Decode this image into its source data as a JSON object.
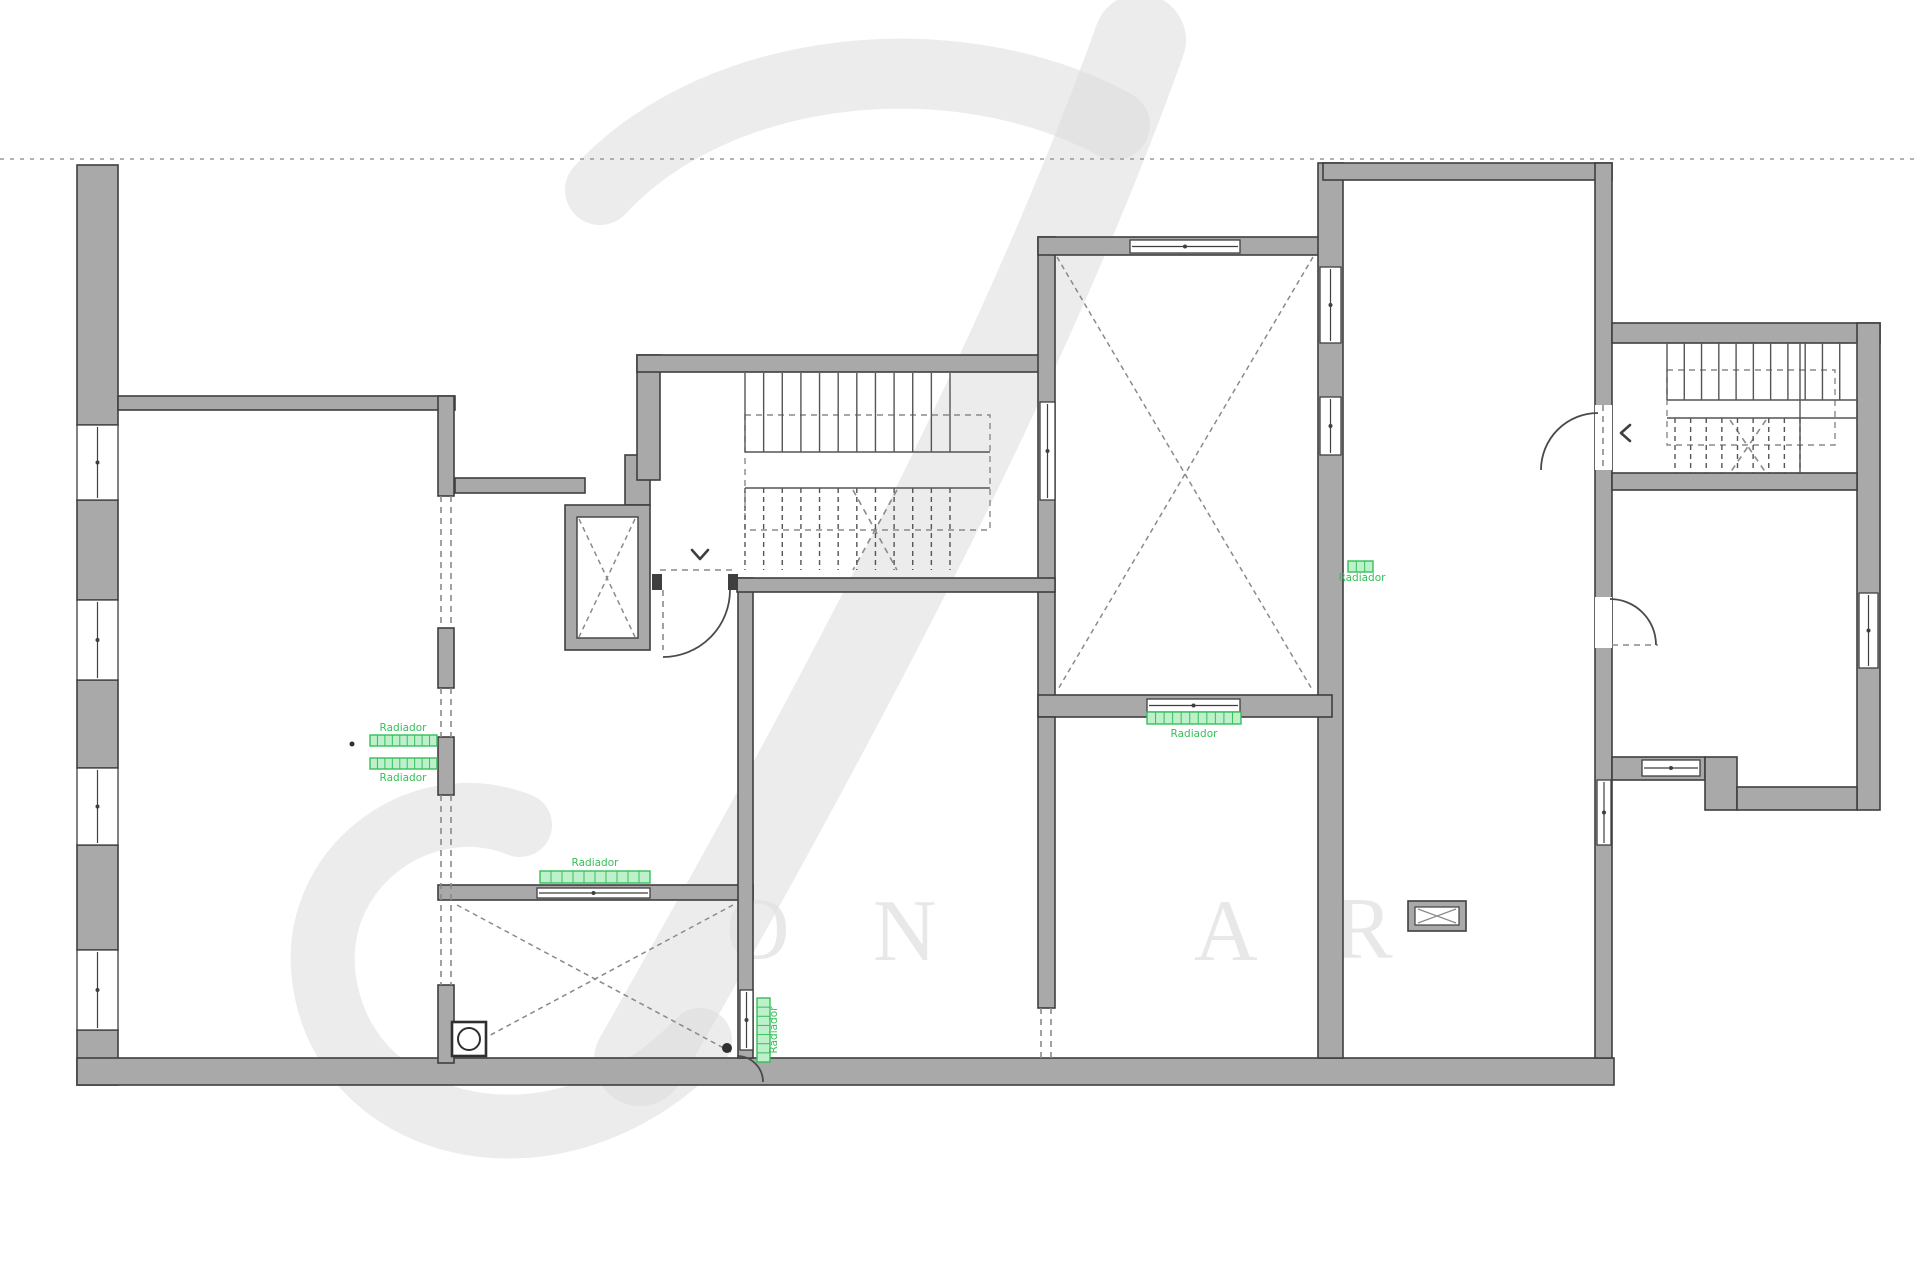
{
  "meta": {
    "title": "Apartment floor plan drawing"
  },
  "colors": {
    "background": "#ffffff",
    "wall_fill": "#a9a9a9",
    "wall_stroke": "#3f3f3f",
    "line_dark": "#3f3f3f",
    "dash_gray": "#8a8a8a",
    "green": "#35c05a",
    "watermark": "#dcdcdc",
    "watermark_letter": "#e3e3e3",
    "boundary_dotted": "#9a9a9a"
  },
  "watermark": {
    "strokes": [
      {
        "d": "M 1140,40 C 1040,320 880,640 640,1060",
        "width": 92
      },
      {
        "d": "M 600,190 C 720,60 960,40 1115,125",
        "width": 70
      },
      {
        "d": "M 700,1040 C 560,1185 350,1135 325,985 C 305,870 420,785 520,825",
        "width": 64
      }
    ],
    "letters": [
      {
        "ch": "O",
        "x": 726,
        "y": 958
      },
      {
        "ch": "N",
        "x": 873,
        "y": 960
      },
      {
        "ch": "A",
        "x": 1194,
        "y": 960
      },
      {
        "ch": "R",
        "x": 1334,
        "y": 958
      }
    ]
  },
  "plan": {
    "boundary_line": {
      "y": 159,
      "x1": 0,
      "x2": 1920
    },
    "walls": [
      [
        77,
        165,
        41,
        260
      ],
      [
        77,
        500,
        41,
        100
      ],
      [
        77,
        680,
        41,
        88
      ],
      [
        77,
        845,
        41,
        105
      ],
      [
        77,
        1030,
        41,
        55
      ],
      [
        77,
        1058,
        1537,
        27
      ],
      [
        118,
        396,
        337,
        14
      ],
      [
        438,
        396,
        16,
        100
      ],
      [
        438,
        628,
        16,
        60
      ],
      [
        438,
        737,
        16,
        58
      ],
      [
        438,
        985,
        16,
        78
      ],
      [
        455,
        478,
        130,
        15
      ],
      [
        625,
        455,
        25,
        50
      ],
      [
        637,
        355,
        23,
        125
      ],
      [
        637,
        355,
        410,
        17
      ],
      [
        1038,
        237,
        17,
        480
      ],
      [
        1038,
        237,
        294,
        18
      ],
      [
        1318,
        163,
        25,
        895
      ],
      [
        1038,
        695,
        294,
        22
      ],
      [
        1323,
        163,
        289,
        17
      ],
      [
        1595,
        163,
        17,
        895
      ],
      [
        1612,
        323,
        268,
        20
      ],
      [
        1857,
        323,
        23,
        487
      ],
      [
        1612,
        473,
        245,
        17
      ],
      [
        1612,
        757,
        93,
        23
      ],
      [
        1705,
        757,
        32,
        53
      ],
      [
        1737,
        787,
        120,
        23
      ],
      [
        438,
        885,
        315,
        15
      ],
      [
        738,
        578,
        15,
        480
      ],
      [
        737,
        578,
        318,
        14
      ],
      [
        1038,
        717,
        17,
        291
      ]
    ],
    "shaft": {
      "outer": [
        565,
        505,
        85,
        145
      ],
      "inner": [
        577,
        517,
        61,
        121
      ]
    },
    "windows": [
      {
        "x": 77,
        "y": 425,
        "w": 41,
        "h": 75,
        "o": "v"
      },
      {
        "x": 77,
        "y": 600,
        "w": 41,
        "h": 80,
        "o": "v"
      },
      {
        "x": 77,
        "y": 768,
        "w": 41,
        "h": 77,
        "o": "v"
      },
      {
        "x": 77,
        "y": 950,
        "w": 41,
        "h": 80,
        "o": "v"
      },
      {
        "x": 1130,
        "y": 240,
        "w": 110,
        "h": 13,
        "o": "h"
      },
      {
        "x": 1040,
        "y": 402,
        "w": 15,
        "h": 98,
        "o": "v"
      },
      {
        "x": 1320,
        "y": 267,
        "w": 21,
        "h": 76,
        "o": "v"
      },
      {
        "x": 1320,
        "y": 397,
        "w": 21,
        "h": 58,
        "o": "v"
      },
      {
        "x": 1147,
        "y": 699,
        "w": 93,
        "h": 13,
        "o": "h"
      },
      {
        "x": 537,
        "y": 888,
        "w": 113,
        "h": 10,
        "o": "h"
      },
      {
        "x": 740,
        "y": 990,
        "w": 13,
        "h": 60,
        "o": "v"
      },
      {
        "x": 1597,
        "y": 780,
        "w": 14,
        "h": 65,
        "o": "v"
      },
      {
        "x": 1859,
        "y": 593,
        "w": 19,
        "h": 75,
        "o": "v"
      },
      {
        "x": 1642,
        "y": 760,
        "w": 58,
        "h": 16,
        "o": "h"
      }
    ],
    "door_gaps": [
      [
        1595,
        405,
        17,
        65
      ],
      [
        1595,
        597,
        17,
        51
      ]
    ],
    "caps": [
      [
        652,
        574,
        10,
        16
      ],
      [
        728,
        574,
        10,
        16
      ]
    ],
    "dashed_lines": [
      [
        441,
        496,
        441,
        628
      ],
      [
        451,
        496,
        451,
        628
      ],
      [
        441,
        688,
        441,
        737
      ],
      [
        451,
        688,
        451,
        737
      ],
      [
        441,
        795,
        441,
        985
      ],
      [
        451,
        795,
        451,
        985
      ],
      [
        660,
        570,
        737,
        570
      ],
      [
        1041,
        1008,
        1041,
        1058
      ],
      [
        1051,
        1008,
        1051,
        1058
      ],
      [
        663,
        590,
        663,
        650
      ],
      [
        1603,
        405,
        1603,
        470
      ],
      [
        1612,
        645,
        1658,
        645
      ],
      [
        853,
        490,
        897,
        570
      ],
      [
        897,
        490,
        853,
        570
      ],
      [
        1730,
        420,
        1766,
        473
      ],
      [
        1766,
        420,
        1730,
        473
      ]
    ],
    "dashed_rects": [
      [
        745,
        415,
        245,
        115
      ],
      [
        1667,
        370,
        168,
        75
      ]
    ],
    "cross_rooms": [
      [
        1057,
        257,
        1313,
        691
      ],
      [
        457,
        905,
        733,
        1053
      ],
      [
        579,
        519,
        635,
        637
      ]
    ],
    "stairs": [
      {
        "x1": 745,
        "x2": 950,
        "y": 373,
        "h": 79,
        "n": 11,
        "dashed": false
      },
      {
        "x1": 745,
        "x2": 950,
        "y": 488,
        "h": 82,
        "n": 11,
        "dashed": true
      },
      {
        "x1": 1667,
        "x2": 1857,
        "y": 343,
        "h": 57,
        "n": 11,
        "dashed": false
      },
      {
        "x1": 1675,
        "x2": 1800,
        "y": 418,
        "h": 55,
        "n": 8,
        "dashed": true
      }
    ],
    "solid_lines": [
      [
        745,
        452,
        990,
        452
      ],
      [
        745,
        488,
        990,
        488
      ],
      [
        1667,
        400,
        1857,
        400
      ],
      [
        1667,
        418,
        1857,
        418
      ],
      [
        1800,
        343,
        1800,
        473
      ]
    ],
    "arcs": [
      "M 663,657 A 67 67 0 0 0 730,590",
      "M 1541,470 A 57 57 0 0 1 1598,413",
      "M 1656,645 A 46 46 0 0 0 1610,599",
      "M 737,1056 A 26 26 0 0 1 763,1082"
    ],
    "chevrons": [
      {
        "points": "692,550 700,559 708,550"
      },
      {
        "points": "1630,425 1621,433 1630,441"
      }
    ],
    "dots": [
      [
        352,
        744,
        2.5
      ],
      [
        727,
        1048,
        5
      ]
    ],
    "radiators": [
      {
        "x": 370,
        "y": 735,
        "w": 67,
        "h": 11,
        "cells": 9,
        "vert": false
      },
      {
        "x": 370,
        "y": 758,
        "w": 67,
        "h": 11,
        "cells": 9,
        "vert": false
      },
      {
        "x": 540,
        "y": 871,
        "w": 110,
        "h": 12,
        "cells": 10,
        "vert": false
      },
      {
        "x": 757,
        "y": 998,
        "w": 13,
        "h": 64,
        "cells": 7,
        "vert": true
      },
      {
        "x": 1147,
        "y": 712,
        "w": 94,
        "h": 12,
        "cells": 11,
        "vert": false
      },
      {
        "x": 1348,
        "y": 561,
        "w": 25,
        "h": 11,
        "cells": 3,
        "vert": false
      }
    ],
    "labels": [
      {
        "text": "Radiador",
        "x": 403,
        "y": 731,
        "vert": false
      },
      {
        "text": "Radiador",
        "x": 403,
        "y": 781,
        "vert": false
      },
      {
        "text": "Radiador",
        "x": 595,
        "y": 866,
        "vert": false
      },
      {
        "text": "Radiador",
        "x": 777,
        "y": 1030,
        "vert": true
      },
      {
        "text": "Radiador",
        "x": 1194,
        "y": 737,
        "vert": false
      },
      {
        "text": "Radiador",
        "x": 1362,
        "y": 581,
        "vert": false
      }
    ],
    "fixture": {
      "outer": [
        1408,
        901,
        58,
        30
      ],
      "inner": [
        1415,
        907,
        44,
        18
      ]
    },
    "drain": {
      "rect": [
        452,
        1022,
        34,
        34
      ],
      "circle": [
        469,
        1039,
        11
      ]
    }
  }
}
